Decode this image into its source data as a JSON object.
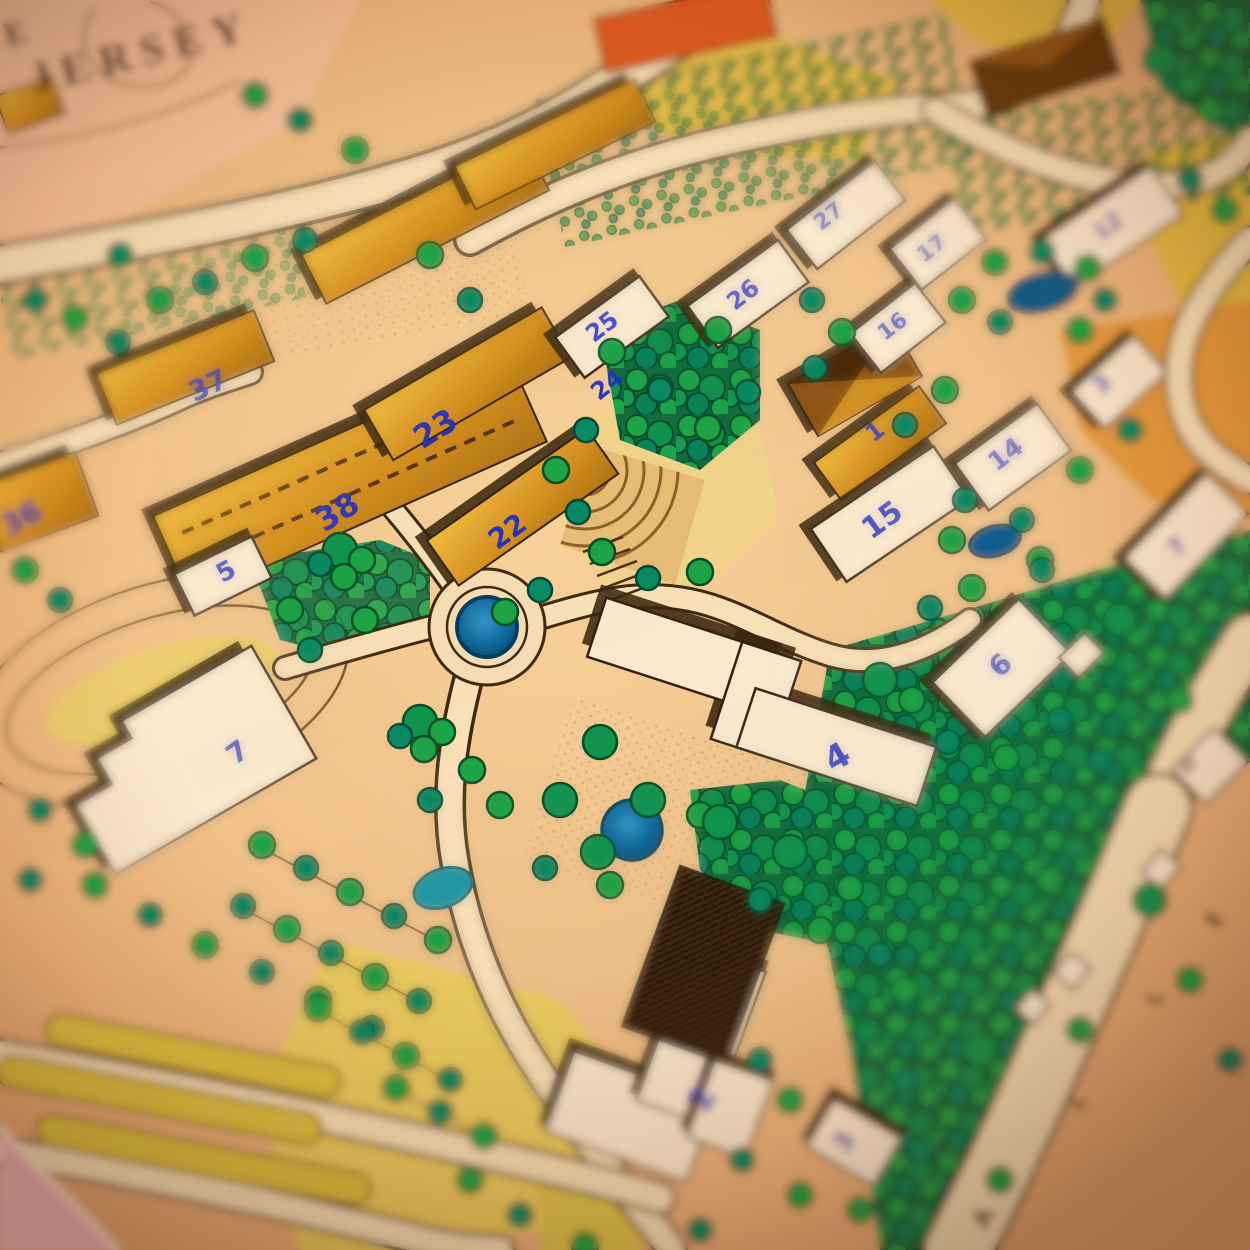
{
  "map": {
    "title_line1": "E",
    "title_line2": "JERSEY",
    "building_labels": [
      {
        "t": "36",
        "x": 26,
        "y": 527,
        "rot": -28,
        "size": 30
      },
      {
        "t": "37",
        "x": 212,
        "y": 394,
        "rot": -25,
        "size": 28
      },
      {
        "t": "23",
        "x": 441,
        "y": 438,
        "rot": -32,
        "size": 32
      },
      {
        "t": "38",
        "x": 343,
        "y": 521,
        "rot": -32,
        "size": 32
      },
      {
        "t": "22",
        "x": 513,
        "y": 539,
        "rot": -36,
        "size": 28
      },
      {
        "t": "24",
        "x": 612,
        "y": 391,
        "rot": -38,
        "size": 24
      },
      {
        "t": "25",
        "x": 607,
        "y": 333,
        "rot": -38,
        "size": 24
      },
      {
        "t": "26",
        "x": 748,
        "y": 301,
        "rot": -38,
        "size": 24
      },
      {
        "t": "27",
        "x": 833,
        "y": 222,
        "rot": -38,
        "size": 22
      },
      {
        "t": "17",
        "x": 936,
        "y": 254,
        "rot": -38,
        "size": 22
      },
      {
        "t": "16",
        "x": 897,
        "y": 332,
        "rot": -38,
        "size": 22
      },
      {
        "t": "12",
        "x": 1112,
        "y": 232,
        "rot": -36,
        "size": 22
      },
      {
        "t": "1",
        "x": 880,
        "y": 438,
        "rot": -38,
        "size": 24
      },
      {
        "t": "15",
        "x": 888,
        "y": 528,
        "rot": -36,
        "size": 30
      },
      {
        "t": "14",
        "x": 1011,
        "y": 461,
        "rot": -38,
        "size": 26
      },
      {
        "t": "3",
        "x": 1107,
        "y": 390,
        "rot": -42,
        "size": 24
      },
      {
        "t": "7",
        "x": 1183,
        "y": 553,
        "rot": -45,
        "size": 24
      },
      {
        "t": "6",
        "x": 1007,
        "y": 672,
        "rot": -44,
        "size": 28
      },
      {
        "t": "4",
        "x": 843,
        "y": 767,
        "rot": -30,
        "size": 34
      },
      {
        "t": "5",
        "x": 230,
        "y": 579,
        "rot": -28,
        "size": 26
      },
      {
        "t": "7",
        "x": 243,
        "y": 760,
        "rot": -36,
        "size": 28
      },
      {
        "t": "2",
        "x": 712,
        "y": 1104,
        "rot": -62,
        "size": 34
      },
      {
        "t": "3",
        "x": 851,
        "y": 1147,
        "rot": -55,
        "size": 26
      }
    ],
    "road_letters": [
      {
        "t": "D",
        "x": 1192,
        "y": 769,
        "rot": -45,
        "size": 20
      },
      {
        "t": "E",
        "x": 1221,
        "y": 924,
        "rot": -55,
        "size": 22
      },
      {
        "t": "L",
        "x": 1161,
        "y": 1002,
        "rot": -55,
        "size": 22
      },
      {
        "t": "L",
        "x": 1084,
        "y": 1106,
        "rot": -55,
        "size": 22
      },
      {
        "t": "A",
        "x": 991,
        "y": 1222,
        "rot": -60,
        "size": 26
      }
    ],
    "colors": {
      "label_blue": "#2733b5",
      "building_gold": "#c9912e",
      "building_white": "#f5ecd8",
      "paper_tan": "#e8c79d",
      "road_cream": "#f2e3c2",
      "tree_green": "#2aa351",
      "tree_teal": "#178a68",
      "water_blue": "#1a72c4",
      "pond_dark": "#125f86",
      "shadow_brown": "#3a2a16",
      "orange_building": "#d4622f",
      "table_pink": "#e9b9c4",
      "title_ink": "#241c1e"
    }
  }
}
